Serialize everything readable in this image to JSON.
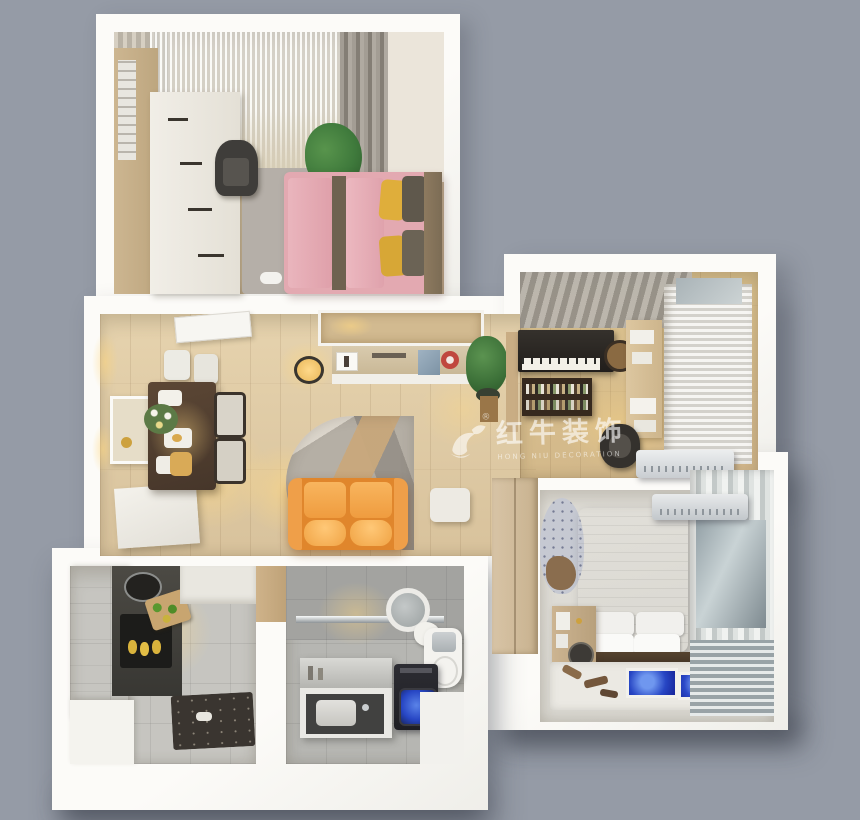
{
  "scene": {
    "description": "3D top-down dollhouse render of a furnished apartment floor plan",
    "background_color": "#959ba6",
    "wall_color": "#f8f7f4"
  },
  "watermark": {
    "logo_icon": "bull-swoosh-logo",
    "registered": "®",
    "brand_cn": "红牛装饰",
    "brand_en": "HONG NIU DECORATION",
    "color": "rgba(255,255,255,0.6)"
  },
  "palette": {
    "sofa_orange": "#e0862c",
    "bed_pink": "#e3a9b1",
    "pillow_yellow": "#dfae3b",
    "master_bed_gray": "#d6d6d3",
    "washer_screen_blue": "#2746c4",
    "plant_green": "#3f7a3c",
    "dining_table_wood": "#503d2c",
    "floor_wood": "#ddc8a3",
    "floor_tile_gray": "#c6c5c0"
  },
  "rooms": [
    {
      "id": "secondary-bedroom",
      "position": "top-left",
      "floor": "light-wood",
      "furniture": [
        "sheer-window-curtain",
        "drape-curtains",
        "tall-wardrobe",
        "white-dresser",
        "chair",
        "potted-plant",
        "gray-rug",
        "pink-double-bed",
        "yellow-pillows",
        "slippers"
      ]
    },
    {
      "id": "living-dining-room",
      "position": "center-left",
      "floor": "light-wood",
      "furniture": [
        "open-door",
        "wall-art",
        "sideboard",
        "dining-table",
        "dining-chairs",
        "tableware",
        "flower-vase",
        "pendant-lamp",
        "tv-console",
        "decor-shelf",
        "potted-plant",
        "geometric-rug",
        "orange-sofa",
        "side-table"
      ]
    },
    {
      "id": "study",
      "position": "top-right",
      "floor": "light-wood",
      "furniture": [
        "striped-mat",
        "upright-piano",
        "piano-stool",
        "wall-bookshelf",
        "desk",
        "desk-chair",
        "window-curtain",
        "air-conditioner"
      ]
    },
    {
      "id": "master-bedroom",
      "position": "right",
      "floor": "gray-carpet",
      "furniture": [
        "sliding-wardrobe",
        "round-lounge-chair",
        "gray-double-bed",
        "white-pillows",
        "nightstand",
        "vanity-mirror",
        "window-curtains",
        "air-conditioner",
        "white-mat",
        "blue-floor-mats",
        "wooden-brushes"
      ]
    },
    {
      "id": "kitchen",
      "position": "bottom-left",
      "floor": "gray-tile",
      "furniture": [
        "white-cabinets",
        "dark-counter",
        "sink",
        "cooktop",
        "cutting-board",
        "vegetables",
        "floor-mat",
        "wood-door"
      ]
    },
    {
      "id": "bathroom",
      "position": "bottom-center",
      "floor": "gray-tile",
      "furniture": [
        "shower-area",
        "glass-partition",
        "round-mirror",
        "towel",
        "toilet",
        "vanity-counter",
        "basin",
        "washing-machine"
      ]
    }
  ]
}
